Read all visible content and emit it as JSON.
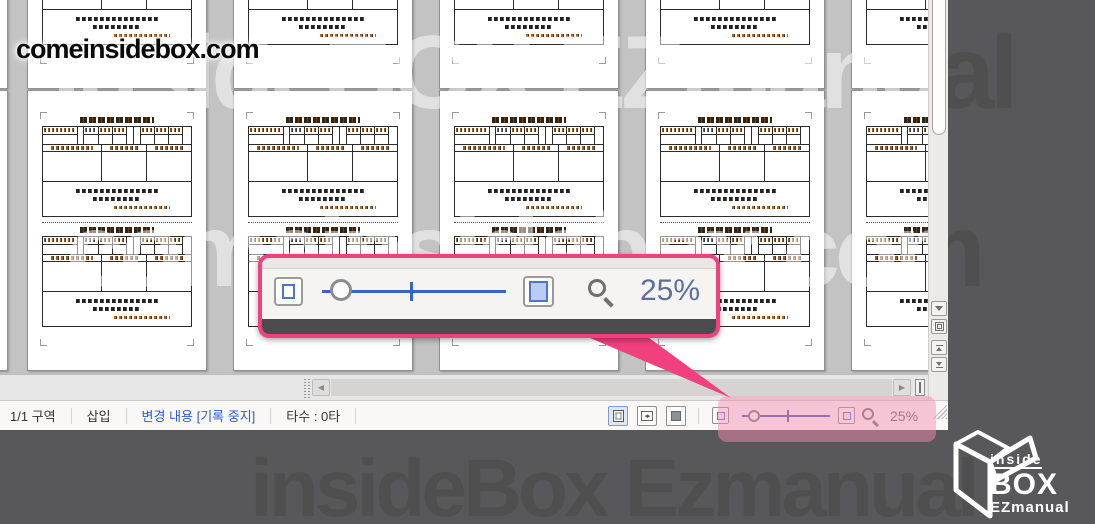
{
  "watermarks": {
    "top_left_text": "comeinsidebox.com",
    "overlay_line1": "InsideBOX EZmanual",
    "overlay_line2": "comeinsidebox.com",
    "bottom_text": "insideBox Ezmanual"
  },
  "zoom_callout": {
    "zoom_value": "25%"
  },
  "status_bar": {
    "section": "1/1 구역",
    "insert_mode": "삽입",
    "track_changes": "변경 내용 [기록 중지]",
    "typing_count": "타수 : 0타",
    "zoom_value": "25%"
  },
  "logo": {
    "top": "inside",
    "middle": "BOX",
    "bottom": "EZmanual"
  },
  "colors": {
    "accent_pink": "#f23f7d",
    "slider_blue": "#3c62c6",
    "track_changes_blue": "#2f5bd0",
    "dark_backdrop": "#58585a"
  }
}
